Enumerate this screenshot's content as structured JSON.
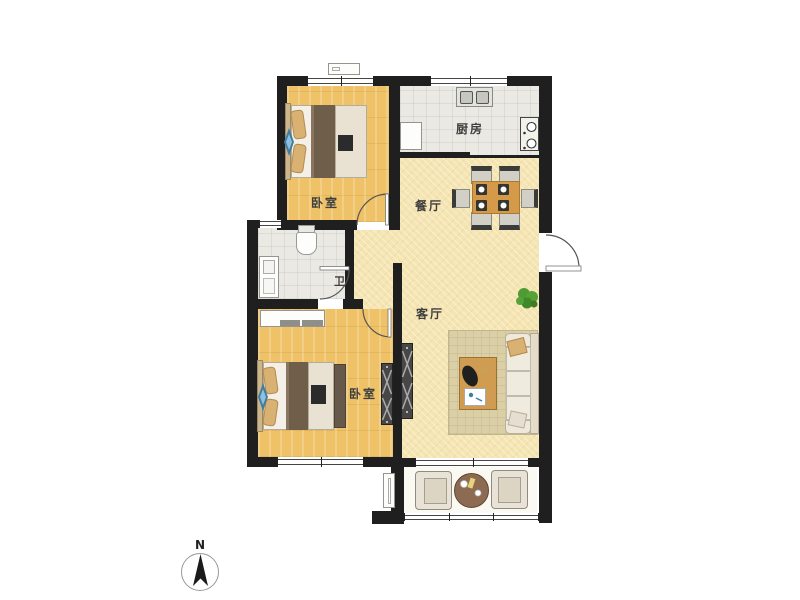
{
  "title": "apartment-floor-plan",
  "compass": {
    "north_label": "N"
  },
  "rooms": [
    {
      "id": "bedroom-top",
      "label": "卧室"
    },
    {
      "id": "kitchen",
      "label": "厨房"
    },
    {
      "id": "dining",
      "label": "餐厅"
    },
    {
      "id": "bathroom",
      "label": "卫"
    },
    {
      "id": "living",
      "label": "客厅"
    },
    {
      "id": "bedroom-bottom",
      "label": "卧室"
    }
  ],
  "colors": {
    "wall": "#1f1f1f",
    "wood": "#efc267",
    "tile": "#ebe9e3",
    "warm": "#f5e5b2",
    "balcony": "#fbfaf2",
    "rug": "#dbcfa5",
    "blanket": "#6f5e4a",
    "pillow": "#d9b273",
    "sheet": "#f4f0e7",
    "dresser": "#e9e2d3",
    "tablewood": "#d49a4a",
    "chair": "#d2cfc7",
    "sofa": "#efe9dc",
    "cabinet": "#474747",
    "plant": "#4f9a32",
    "blue": "#3f7da3",
    "fixture": "#fdfdfb",
    "btable": "#8d6b52"
  }
}
